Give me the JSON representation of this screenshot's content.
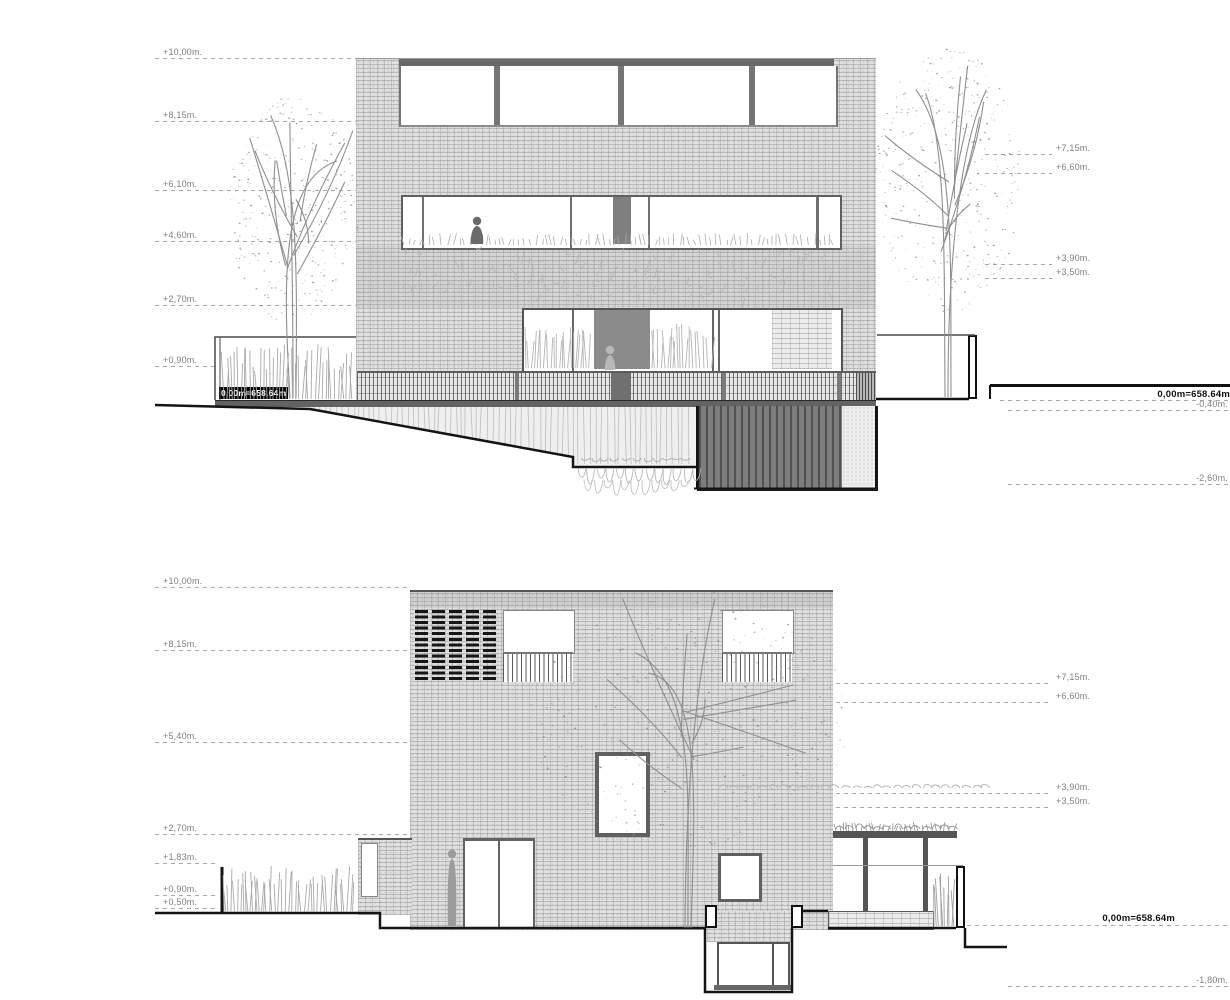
{
  "drawing": {
    "colors": {
      "paper": "#ffffff",
      "brick_field": "#e0e0e0",
      "window_frame": "#606060",
      "dark_panel": "#8b8b8b",
      "slat_wall": "#7d7d7d",
      "terrain_line": "#141414",
      "level_label": "#7f7f7f",
      "datum_box_bg": "#000000",
      "datum_box_fg": "#ffffff"
    },
    "upper_elevation": {
      "levels_left": [
        {
          "label": "+10,00m.",
          "m": 10.0
        },
        {
          "label": "+8,15m.",
          "m": 8.15
        },
        {
          "label": "+6,10m.",
          "m": 6.1
        },
        {
          "label": "+4,60m.",
          "m": 4.6
        },
        {
          "label": "+2,70m.",
          "m": 2.7
        },
        {
          "label": "+0,90m.",
          "m": 0.9
        }
      ],
      "datum_left": "0,00m=658.64m",
      "levels_right": [
        {
          "label": "+7,15m.",
          "m": 7.15
        },
        {
          "label": "+6,60m.",
          "m": 6.6
        },
        {
          "label": "+3,90m.",
          "m": 3.9
        },
        {
          "label": "+3,50m.",
          "m": 3.5
        }
      ],
      "datum_right": "0,00m=658.64m",
      "levels_right_below": [
        {
          "label": "-0,40m.",
          "m": -0.4
        },
        {
          "label": "-2,60m.",
          "m": -2.6
        }
      ]
    },
    "lower_elevation": {
      "levels_left": [
        {
          "label": "+10,00m.",
          "m": 10.0
        },
        {
          "label": "+8,15m.",
          "m": 8.15
        },
        {
          "label": "+5,40m.",
          "m": 5.4
        },
        {
          "label": "+2,70m.",
          "m": 2.7
        },
        {
          "label": "+1,83m.",
          "m": 1.83
        },
        {
          "label": "+0,90m.",
          "m": 0.9
        },
        {
          "label": "+0,50m.",
          "m": 0.5
        }
      ],
      "levels_right": [
        {
          "label": "+7,15m.",
          "m": 7.15
        },
        {
          "label": "+6,60m.",
          "m": 6.6
        },
        {
          "label": "+3,90m.",
          "m": 3.9
        },
        {
          "label": "+3,50m.",
          "m": 3.5
        }
      ],
      "datum_right": "0,00m=658.64m",
      "levels_right_below": [
        {
          "label": "-1,80m.",
          "m": -1.8
        }
      ]
    }
  }
}
